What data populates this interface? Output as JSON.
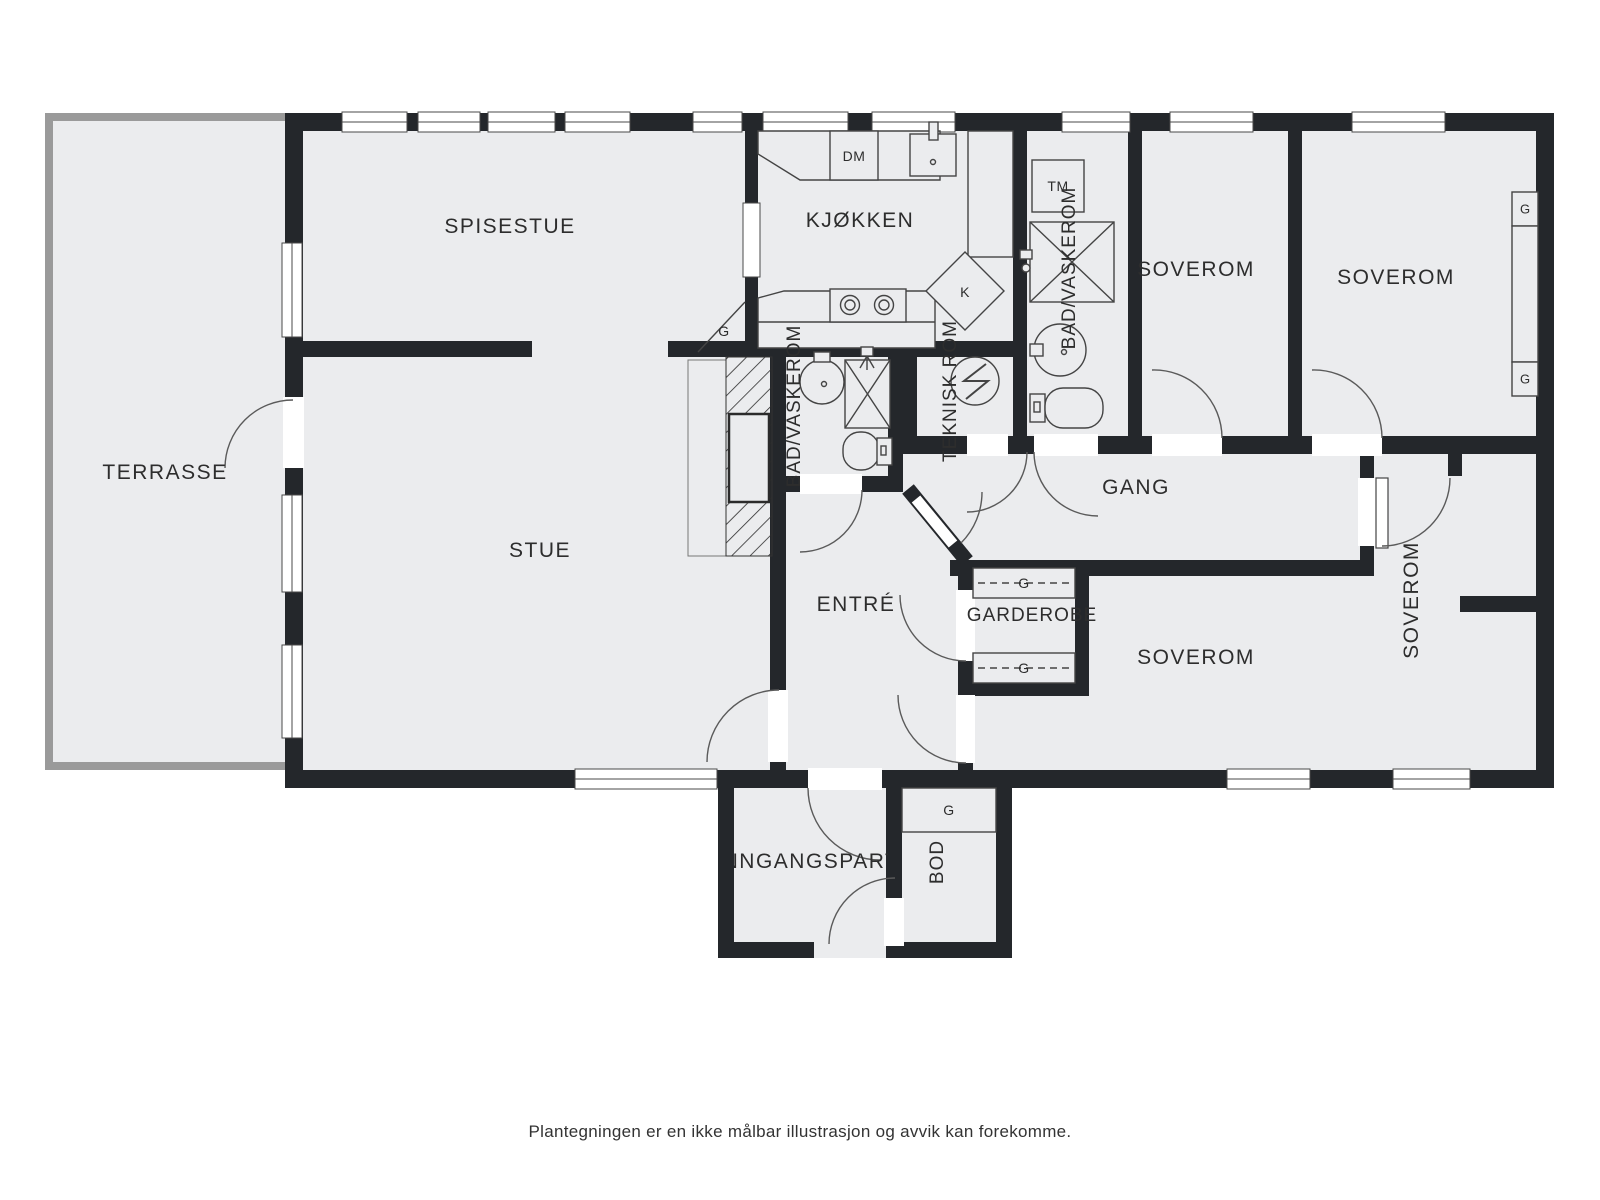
{
  "floorplan": {
    "caption": "Plantegningen er en ikke målbar illustrasjon og avvik kan forekomme.",
    "rooms": {
      "terrasse": "TERRASSE",
      "spisestue": "SPISESTUE",
      "kjokken": "KJØKKEN",
      "stue": "STUE",
      "entre": "ENTRÉ",
      "gang": "GANG",
      "garderobe": "GARDEROBE",
      "bad_vaskerom_1": "BAD/VASKEROM",
      "bad_vaskerom_2": "BAD/VASKEROM",
      "teknisk_rom": "TEKNISK ROM",
      "soverom_topp_1": "SOVEROM",
      "soverom_topp_2": "SOVEROM",
      "soverom_midt": "SOVEROM",
      "soverom_hoyre": "SOVEROM",
      "inngangsparti": "INNGANGSPARTI",
      "bod": "BOD"
    },
    "markers": {
      "oppvaskmaskin": "DM",
      "torketrommel": "TM",
      "kjoleskap": "K",
      "garderobeskap": "G"
    },
    "colors": {
      "wall": "#24272b",
      "floor": "#ebecee",
      "terrace_edge": "#9a9a9a",
      "text": "#2d2d2d"
    }
  }
}
